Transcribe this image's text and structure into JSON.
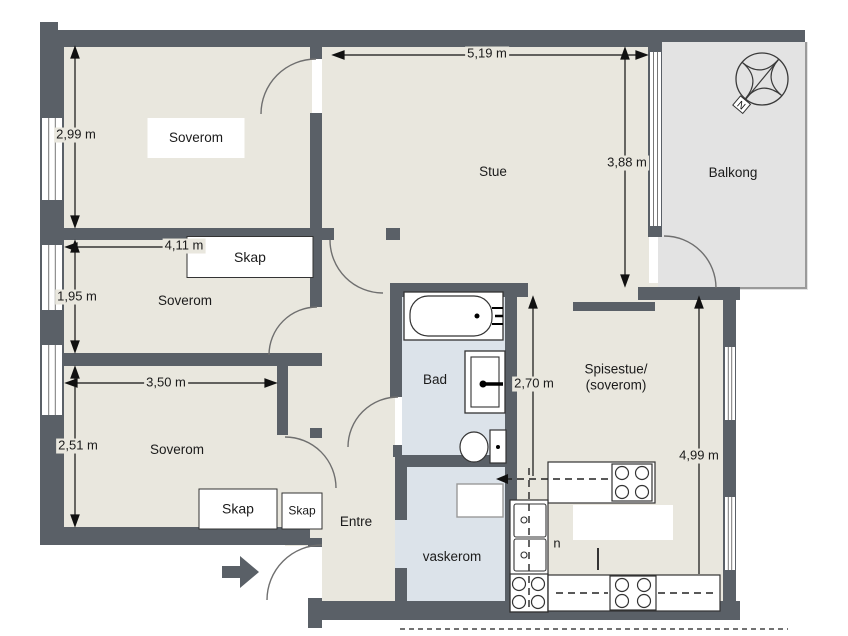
{
  "rooms": [
    {
      "id": "soverom-1",
      "label": "Soverom"
    },
    {
      "id": "soverom-2",
      "label": "Soverom"
    },
    {
      "id": "soverom-3",
      "label": "Soverom"
    },
    {
      "id": "stue",
      "label": "Stue"
    },
    {
      "id": "balkong",
      "label": "Balkong"
    },
    {
      "id": "bad",
      "label": "Bad"
    },
    {
      "id": "spisestue",
      "label": "Spisestue/\n(soverom)"
    },
    {
      "id": "entre",
      "label": "Entre"
    },
    {
      "id": "vaskerom",
      "label": "vaskerom"
    }
  ],
  "closets": [
    {
      "id": "skap-soverom-2",
      "label": "Skap"
    },
    {
      "id": "skap-soverom-3-large",
      "label": "Skap"
    },
    {
      "id": "skap-soverom-3-small",
      "label": "Skap"
    }
  ],
  "dimensions": [
    {
      "id": "soverom-1-height",
      "text": "2,99 m"
    },
    {
      "id": "soverom-2-width",
      "text": "4,11 m"
    },
    {
      "id": "soverom-2-height",
      "text": "1,95 m"
    },
    {
      "id": "soverom-3-width",
      "text": "3,50 m"
    },
    {
      "id": "soverom-3-height",
      "text": "2,51 m"
    },
    {
      "id": "stue-width",
      "text": "5,19 m"
    },
    {
      "id": "stue-height",
      "text": "3,88 m"
    },
    {
      "id": "passage-height",
      "text": "2,70 m"
    },
    {
      "id": "spisestue-height",
      "text": "4,99 m"
    }
  ],
  "annotations": {
    "n_label": "n",
    "compass_north": "N"
  },
  "colors": {
    "wall": "#5a6067",
    "floor": "#e9e7de",
    "wet_room_floor": "#dce3ea",
    "balcony_floor": "#e3e3e3",
    "outline": "#2e2e2e",
    "text": "#1b1b1b"
  }
}
